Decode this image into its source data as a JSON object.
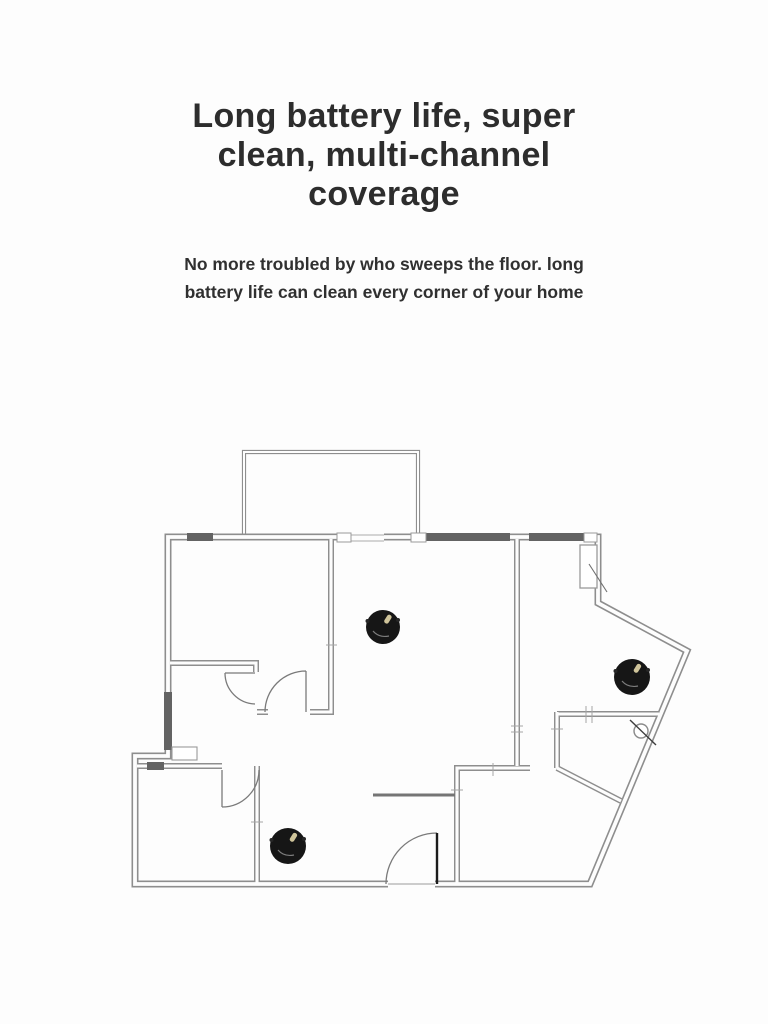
{
  "page": {
    "background_color": "#fdfdfd"
  },
  "header": {
    "title": "Long battery life, super\nclean, multi-channel\ncoverage",
    "subtitle": "No more troubled by who sweeps the floor. long\nbattery life can clean every corner of your home",
    "title_color": "#2d2d2d",
    "subtitle_color": "#303030"
  },
  "floorplan": {
    "description": "apartment floor plan with three robot vacuum cleaners",
    "wall_color": "#8e8e8e",
    "window_fill_color": "#636363",
    "door_line_color": "#7a7a7a",
    "robot_color": "#161616",
    "robot_sensor_color": "#cfc49a",
    "robots": [
      {
        "name": "robot-vacuum-living-room",
        "cx": 383,
        "cy": 627,
        "r": 17
      },
      {
        "name": "robot-vacuum-right-room",
        "cx": 632,
        "cy": 677,
        "r": 18
      },
      {
        "name": "robot-vacuum-bottom-room",
        "cx": 288,
        "cy": 846,
        "r": 18
      }
    ]
  }
}
